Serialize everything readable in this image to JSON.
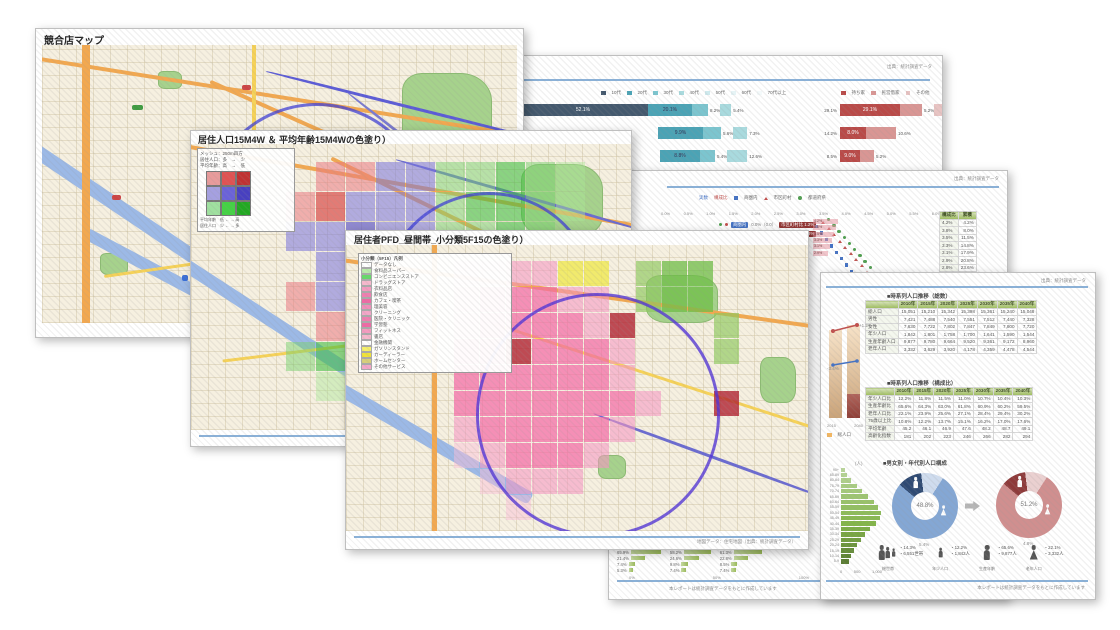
{
  "pages": {
    "map_overview": {
      "title": "競合店マップ",
      "footer": "地図データ：住宅地図（出典：統計調査データ）"
    },
    "map_mesh": {
      "title": "居住人口15M4W ＆ 平均年齢15M4Wの色塗り）",
      "legend": {
        "note_lines": [
          "メッシュ：250m四方",
          "居住人口：多　→　少",
          "平均年齢：高　→　低"
        ],
        "matrix": [
          "#e89b9b",
          "#e05252",
          "#c03232",
          "#a5a0e0",
          "#6a62d8",
          "#4840c0",
          "#9fe09f",
          "#44d244",
          "#22a822"
        ],
        "axis_lines": [
          "平均年齢　低 ← → 高",
          "居住人口　少 ← → 多"
        ]
      },
      "footer": "地図データ：住宅地図（出典：統計調査データ）"
    },
    "map_pfd": {
      "title": "居住者PFD_昼間帯_小分類5F15の色塗り）",
      "legend_title": "小分類（5F15）凡例",
      "legend_items": [
        {
          "color": "#ffffff",
          "label": "データなし"
        },
        {
          "color": "#b9ecaa",
          "label": "食料品スーパー"
        },
        {
          "color": "#66d96a",
          "label": "コンビニエンスストア"
        },
        {
          "color": "#f6b8cc",
          "label": "ドラッグストア"
        },
        {
          "color": "#f49bbf",
          "label": "衣料品店"
        },
        {
          "color": "#ef7fb0",
          "label": "飲食店"
        },
        {
          "color": "#ee6aa5",
          "label": "カフェ・喫茶"
        },
        {
          "color": "#f08fba",
          "label": "理美容"
        },
        {
          "color": "#f4a6c8",
          "label": "クリーニング"
        },
        {
          "color": "#ef7fb0",
          "label": "医院・クリニック"
        },
        {
          "color": "#ee6aa5",
          "label": "学習塾"
        },
        {
          "color": "#f49bbf",
          "label": "フィットネス"
        },
        {
          "color": "#f6b8cc",
          "label": "書店"
        },
        {
          "color": "#ffffff",
          "label": "金融機関"
        },
        {
          "color": "#f5f06a",
          "label": "ガソリンスタンド"
        },
        {
          "color": "#efe23a",
          "label": "カーディーラー"
        },
        {
          "color": "#d8cf7a",
          "label": "ホームセンター"
        },
        {
          "color": "#f4a6c8",
          "label": "その他サービス"
        }
      ],
      "footer": "地図データ：住宅地図（出典：統計調査データ）"
    },
    "report_age": {
      "header_note": "出典：統計調査データ",
      "legend_left": [
        {
          "color": "#44596e",
          "label": "10代"
        },
        {
          "color": "#4ba3b5",
          "label": "20代"
        },
        {
          "color": "#7cc5cf",
          "label": "30代"
        },
        {
          "color": "#a9dade",
          "label": "40代"
        },
        {
          "color": "#cfeaee",
          "label": "50代"
        },
        {
          "color": "#e6f4f6",
          "label": "60代"
        },
        {
          "color": "#f4fafb",
          "label": "70代以上"
        }
      ],
      "legend_right": [
        {
          "color": "#b94a48",
          "label": "持ち家"
        },
        {
          "color": "#d99694",
          "label": "民営借家"
        },
        {
          "color": "#e8c4c3",
          "label": "その他"
        }
      ],
      "palette_left": [
        "#44596e",
        "#4ba3b5",
        "#7cc5cf",
        "#a9dade",
        "#cfeaee"
      ],
      "palette_right": [
        "#b94a48",
        "#d99694",
        "#e8c4c3"
      ],
      "bars_left": [
        {
          "offset": 0,
          "segments": [
            {
              "w": 130,
              "label": "52.1%",
              "ci": 0,
              "inside": true
            },
            {
              "w": 44,
              "label": "20.1%",
              "ci": 1,
              "inside": true
            },
            {
              "w": 16,
              "label": "8.2%",
              "ci": 2,
              "inside": false
            },
            {
              "w": 11,
              "label": "5.4%",
              "ci": 3,
              "inside": false
            }
          ]
        },
        {
          "offset": 140,
          "segments": [
            {
              "w": 45,
              "label": "9.9%",
              "ci": 1,
              "inside": true
            },
            {
              "w": 18,
              "label": "5.6%",
              "ci": 2,
              "inside": false
            },
            {
              "w": 14,
              "label": "7.3%",
              "ci": 3,
              "inside": false
            }
          ]
        },
        {
          "offset": 142,
          "segments": [
            {
              "w": 40,
              "label": "8.8%",
              "ci": 1,
              "inside": true
            },
            {
              "w": 15,
              "label": "5.4%",
              "ci": 2,
              "inside": false
            },
            {
              "w": 20,
              "label": "12.6%",
              "ci": 3,
              "inside": false
            }
          ]
        }
      ],
      "bars_right": [
        {
          "lead": "29.1%",
          "segments": [
            {
              "w": 60,
              "label": "29.1%",
              "ci": 0,
              "inside": true
            },
            {
              "w": 22,
              "label": "5.2%",
              "ci": 1,
              "inside": false
            },
            {
              "w": 14,
              "label": "3.8%",
              "ci": 2,
              "inside": false
            }
          ]
        },
        {
          "lead": "14.2%",
          "segments": [
            {
              "w": 26,
              "label": "8.0%",
              "ci": 0,
              "inside": true
            },
            {
              "w": 30,
              "label": "10.6%",
              "ci": 1,
              "inside": false
            }
          ]
        },
        {
          "lead": "8.5%",
          "segments": [
            {
              "w": 20,
              "label": "9.0%",
              "ci": 0,
              "inside": true
            },
            {
              "w": 14,
              "label": "5.2%",
              "ci": 1,
              "inside": false
            }
          ]
        }
      ]
    },
    "report_share": {
      "header_note": "出典：統計調査データ",
      "legend": [
        {
          "mark": "textb",
          "label": "実数"
        },
        {
          "mark": "textr",
          "label": "構成比"
        },
        {
          "mark": "sq",
          "label": "商圏内"
        },
        {
          "mark": "tri",
          "label": "市区町村"
        },
        {
          "mark": "dot",
          "label": "都道府県"
        }
      ],
      "series_colors": {
        "sq": "#4472c4",
        "tri": "#c0504d",
        "dot": "#4f9e4f"
      },
      "axis": [
        "0.0%",
        "0.5%",
        "1.0%",
        "1.5%",
        "2.0%",
        "2.5%",
        "3.0%",
        "3.5%",
        "4.0%",
        "4.5%",
        "5.0%",
        "5.5%",
        "6.0%"
      ],
      "chips": [
        {
          "chip1": "商圏内",
          "mid": "0.0%（0.0）",
          "chip2": "市区町村比 1.2%"
        },
        {
          "chip1": "商圏外",
          "mid": "0.0%（0.0）",
          "chip2": "都道府県比 0.8%"
        }
      ],
      "pareto_labels": [
        "4.2%",
        "3.8%",
        "3.5%",
        "3.3%",
        "3.1%",
        "2.9%"
      ],
      "table": {
        "header": [
          "構成比",
          "累積"
        ],
        "rows": [
          [
            "4.2%",
            "4.2%"
          ],
          [
            "3.8%",
            "8.0%"
          ],
          [
            "3.5%",
            "11.5%"
          ],
          [
            "3.3%",
            "14.8%"
          ],
          [
            "3.1%",
            "17.9%"
          ],
          [
            "2.9%",
            "20.8%"
          ],
          [
            "2.8%",
            "23.6%"
          ],
          [
            "2.6%",
            "26.2%"
          ],
          [
            "2.5%",
            "28.7%"
          ],
          [
            "2.4%",
            "31.1%"
          ],
          [
            "2.3%",
            "33.4%"
          ],
          [
            "2.2%",
            "35.6%"
          ]
        ]
      },
      "mini_blocks": [
        {
          "rows": [
            {
              "label": "65.9%",
              "w": 30
            },
            {
              "label": "21.4%",
              "w": 14
            },
            {
              "label": "7.4%",
              "w": 6
            },
            {
              "label": "5.3%",
              "w": 4
            }
          ]
        },
        {
          "rows": [
            {
              "label": "58.2%",
              "w": 27
            },
            {
              "label": "24.6%",
              "w": 15
            },
            {
              "label": "9.8%",
              "w": 7
            },
            {
              "label": "7.4%",
              "w": 5
            }
          ]
        },
        {
          "rows": [
            {
              "label": "61.3%",
              "w": 28
            },
            {
              "label": "22.8%",
              "w": 14
            },
            {
              "label": "8.5%",
              "w": 6
            },
            {
              "label": "7.4%",
              "w": 5
            }
          ]
        }
      ],
      "mini_axis": [
        "0%",
        "50%",
        "100%"
      ],
      "footer": "本レポートは統計調査データをもとに作成しています"
    },
    "report_population": {
      "header_note": "出典：統計調査データ",
      "section1": {
        "title": "■時系列人口推移（総数）",
        "table": {
          "header": [
            "",
            "2010年",
            "2015年",
            "2020年",
            "2025年",
            "2030年",
            "2035年",
            "2040年"
          ],
          "rows": [
            [
              "総人口",
              "15,051",
              "15,210",
              "15,342",
              "15,398",
              "15,361",
              "15,240",
              "15,048"
            ],
            [
              "男性",
              "7,421",
              "7,488",
              "7,540",
              "7,551",
              "7,512",
              "7,440",
              "7,328"
            ],
            [
              "女性",
              "7,630",
              "7,722",
              "7,802",
              "7,847",
              "7,849",
              "7,800",
              "7,720"
            ],
            [
              "年少人口",
              "1,842",
              "1,801",
              "1,758",
              "1,700",
              "1,641",
              "1,590",
              "1,544"
            ],
            [
              "生産年齢人口",
              "9,877",
              "9,780",
              "9,664",
              "9,520",
              "9,361",
              "9,172",
              "8,960"
            ],
            [
              "老年人口",
              "3,332",
              "3,629",
              "3,920",
              "4,178",
              "4,359",
              "4,478",
              "4,544"
            ]
          ]
        }
      },
      "trend_chart": {
        "bar_labels": [
          "2015",
          "2040"
        ],
        "delta_top": "+1.2%",
        "delta_mid": "-3.4%",
        "legend": "総人口"
      },
      "section2": {
        "title": "■時系列人口推移（構成比）",
        "table": {
          "header": [
            "",
            "2010年",
            "2015年",
            "2020年",
            "2025年",
            "2030年",
            "2035年",
            "2040年"
          ],
          "rows": [
            [
              "年少人口比",
              "12.2%",
              "11.8%",
              "11.5%",
              "11.0%",
              "10.7%",
              "10.4%",
              "10.3%"
            ],
            [
              "生産年齢比",
              "65.6%",
              "64.3%",
              "63.0%",
              "61.8%",
              "60.9%",
              "60.2%",
              "59.5%"
            ],
            [
              "老年人口比",
              "22.1%",
              "23.9%",
              "25.6%",
              "27.1%",
              "28.4%",
              "29.4%",
              "30.2%"
            ],
            [
              "75歳以上比",
              "10.8%",
              "12.2%",
              "13.7%",
              "15.1%",
              "16.2%",
              "17.0%",
              "17.6%"
            ],
            [
              "平均年齢",
              "45.2",
              "46.1",
              "46.9",
              "47.6",
              "48.2",
              "48.7",
              "49.1"
            ],
            [
              "高齢化指数",
              "181",
              "202",
              "223",
              "246",
              "266",
              "282",
              "294"
            ]
          ]
        }
      },
      "section3": {
        "title": "■男女別・年代別人口構成",
        "pyramid": {
          "unit": "(人)",
          "ages": [
            "90+",
            "85-89",
            "80-84",
            "75-79",
            "70-74",
            "65-69",
            "60-64",
            "55-59",
            "50-54",
            "45-49",
            "40-44",
            "35-39",
            "30-34",
            "25-29",
            "20-24",
            "15-19",
            "10-14",
            "5-9"
          ],
          "values": [
            3,
            5,
            8,
            12,
            16,
            20,
            25,
            28,
            30,
            29,
            26,
            22,
            18,
            15,
            12,
            10,
            8,
            6
          ],
          "ticks": [
            "0",
            "500",
            "1,000"
          ]
        },
        "donut_left": {
          "center": "48.8%",
          "sub": "5.4%",
          "segments": [
            {
              "value": 12,
              "color": "#2f4a73"
            },
            {
              "value": 11,
              "color": "#cfdcee"
            },
            {
              "value": 77,
              "color": "#84a7d4"
            }
          ]
        },
        "donut_right": {
          "center": "51.2%",
          "sub": "4.8%",
          "segments": [
            {
              "value": 12,
              "color": "#8e3a3a"
            },
            {
              "value": 11,
              "color": "#ead0d0"
            },
            {
              "value": 77,
              "color": "#d08f8f"
            }
          ]
        },
        "people": [
          {
            "glyph": "family",
            "label": "総世帯",
            "lines": [
              "・14.3%",
              "・6,551世帯"
            ]
          },
          {
            "glyph": "child",
            "label": "年少人口",
            "lines": [
              "・12.2%",
              "・1,842人"
            ]
          },
          {
            "glyph": "male",
            "label": "生産年齢",
            "lines": [
              "・65.6%",
              "・9,877人"
            ]
          },
          {
            "glyph": "female",
            "label": "老年人口",
            "lines": [
              "・22.1%",
              "・3,332人"
            ]
          }
        ]
      },
      "footer": "本レポートは統計調査データをもとに作成しています"
    },
    "mesh_b": {
      "palette": {
        "p": "rgba(120,115,220,.55)",
        "P": "rgba(80,75,200,.62)",
        "r": "rgba(235,120,130,.55)",
        "R": "rgba(215,60,60,.65)",
        "g": "rgba(120,210,110,.5)",
        "G": "rgba(60,190,60,.58)",
        "l": "rgba(170,230,150,.45)"
      },
      "rows": [
        ". r r p p g g G g l .",
        "r R p p p g G G g l .",
        "p p P p p g g G g . .",
        ". p p P p p g g . . .",
        "r p p p P p g . . . .",
        ". r p p p p . . . . .",
        "g G p r p r r . . . .",
        ". l . r r . r . . . .",
        ". . l . r . . . . . ."
      ]
    },
    "mesh_c": {
      "palette": {
        "a": "rgba(244,105,165,.72)",
        "b": "rgba(247,150,195,.58)",
        "c": "rgba(250,190,215,.48)",
        "d": "rgba(176,32,48,.8)",
        "y": "rgba(240,232,80,.8)",
        "g": "rgba(140,200,90,.65)",
        "G": "rgba(110,190,70,.75)"
      },
      "rows": [
        "c c b b y y . g G G . .",
        "b a a a b b . g G G . .",
        "b a a a a b d . . . g .",
        "a a d a a a b . . . g .",
        "a a a a a a b . . . . .",
        "a a a a a a a b . . d .",
        "b a a a a a b . . . . .",
        "c b a a a b . . . . . .",
        ". c b b b . . . . . . .",
        ". . c . . . . . . . . ."
      ]
    }
  }
}
